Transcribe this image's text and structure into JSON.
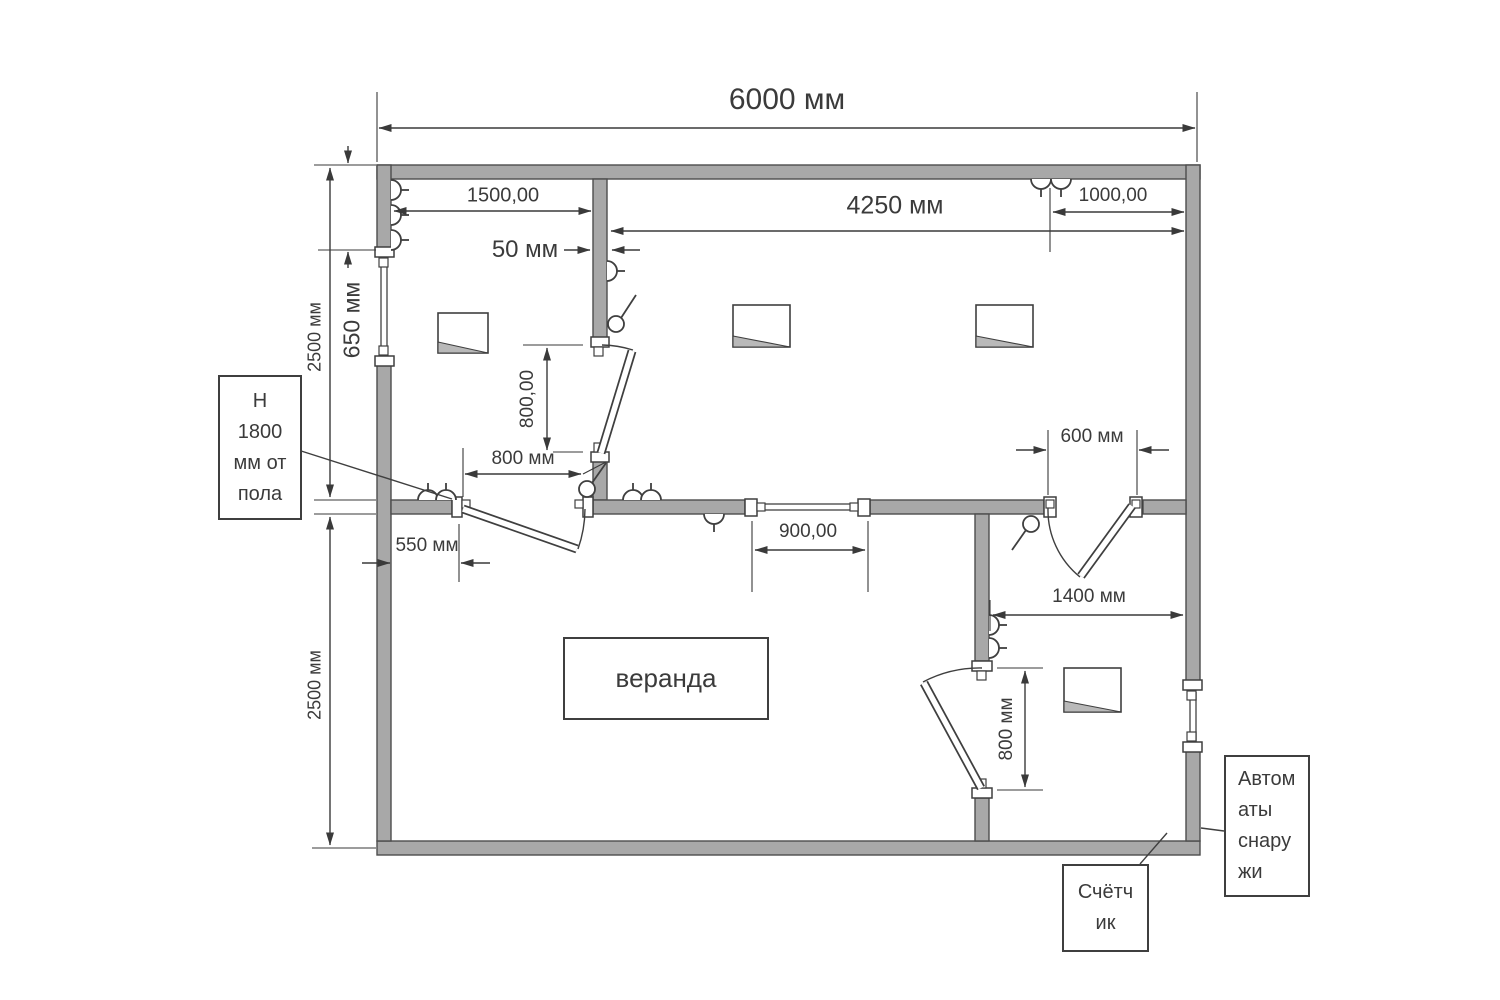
{
  "drawing": {
    "dimensions": {
      "total_width": "6000 мм",
      "room_left_width": "1500,00",
      "room_right_width": "4250 мм",
      "top_right_offset": "1000,00",
      "partition_thickness": "50 мм",
      "left_window_offset": "650 мм",
      "upper_section_height": "2500 мм",
      "lower_section_height": "2500 мм",
      "inner_door_width": "800,00",
      "switch_distance": "800 мм",
      "veranda_door_offset": "550 мм",
      "middle_window_width": "900,00",
      "right_door_width": "600 мм",
      "small_room_width": "1400 мм",
      "small_room_door_width": "800 мм"
    },
    "labels": {
      "veranda": "веранда",
      "height_note": {
        "text": "Н 1800 мм от пола",
        "lines": [
          "Н",
          "1800",
          "мм от",
          "пола"
        ]
      },
      "meter": {
        "text": "Счётчик",
        "lines": [
          "Счётч",
          "ик"
        ]
      },
      "breakers": {
        "text": "Автоматы снаружи",
        "lines": [
          "Автом",
          "аты",
          "снару",
          "жи"
        ]
      }
    },
    "colors": {
      "wall_fill": "#a8a8a8",
      "line": "#3a3a3a",
      "background": "#ffffff",
      "text": "#3b3b3b"
    }
  }
}
